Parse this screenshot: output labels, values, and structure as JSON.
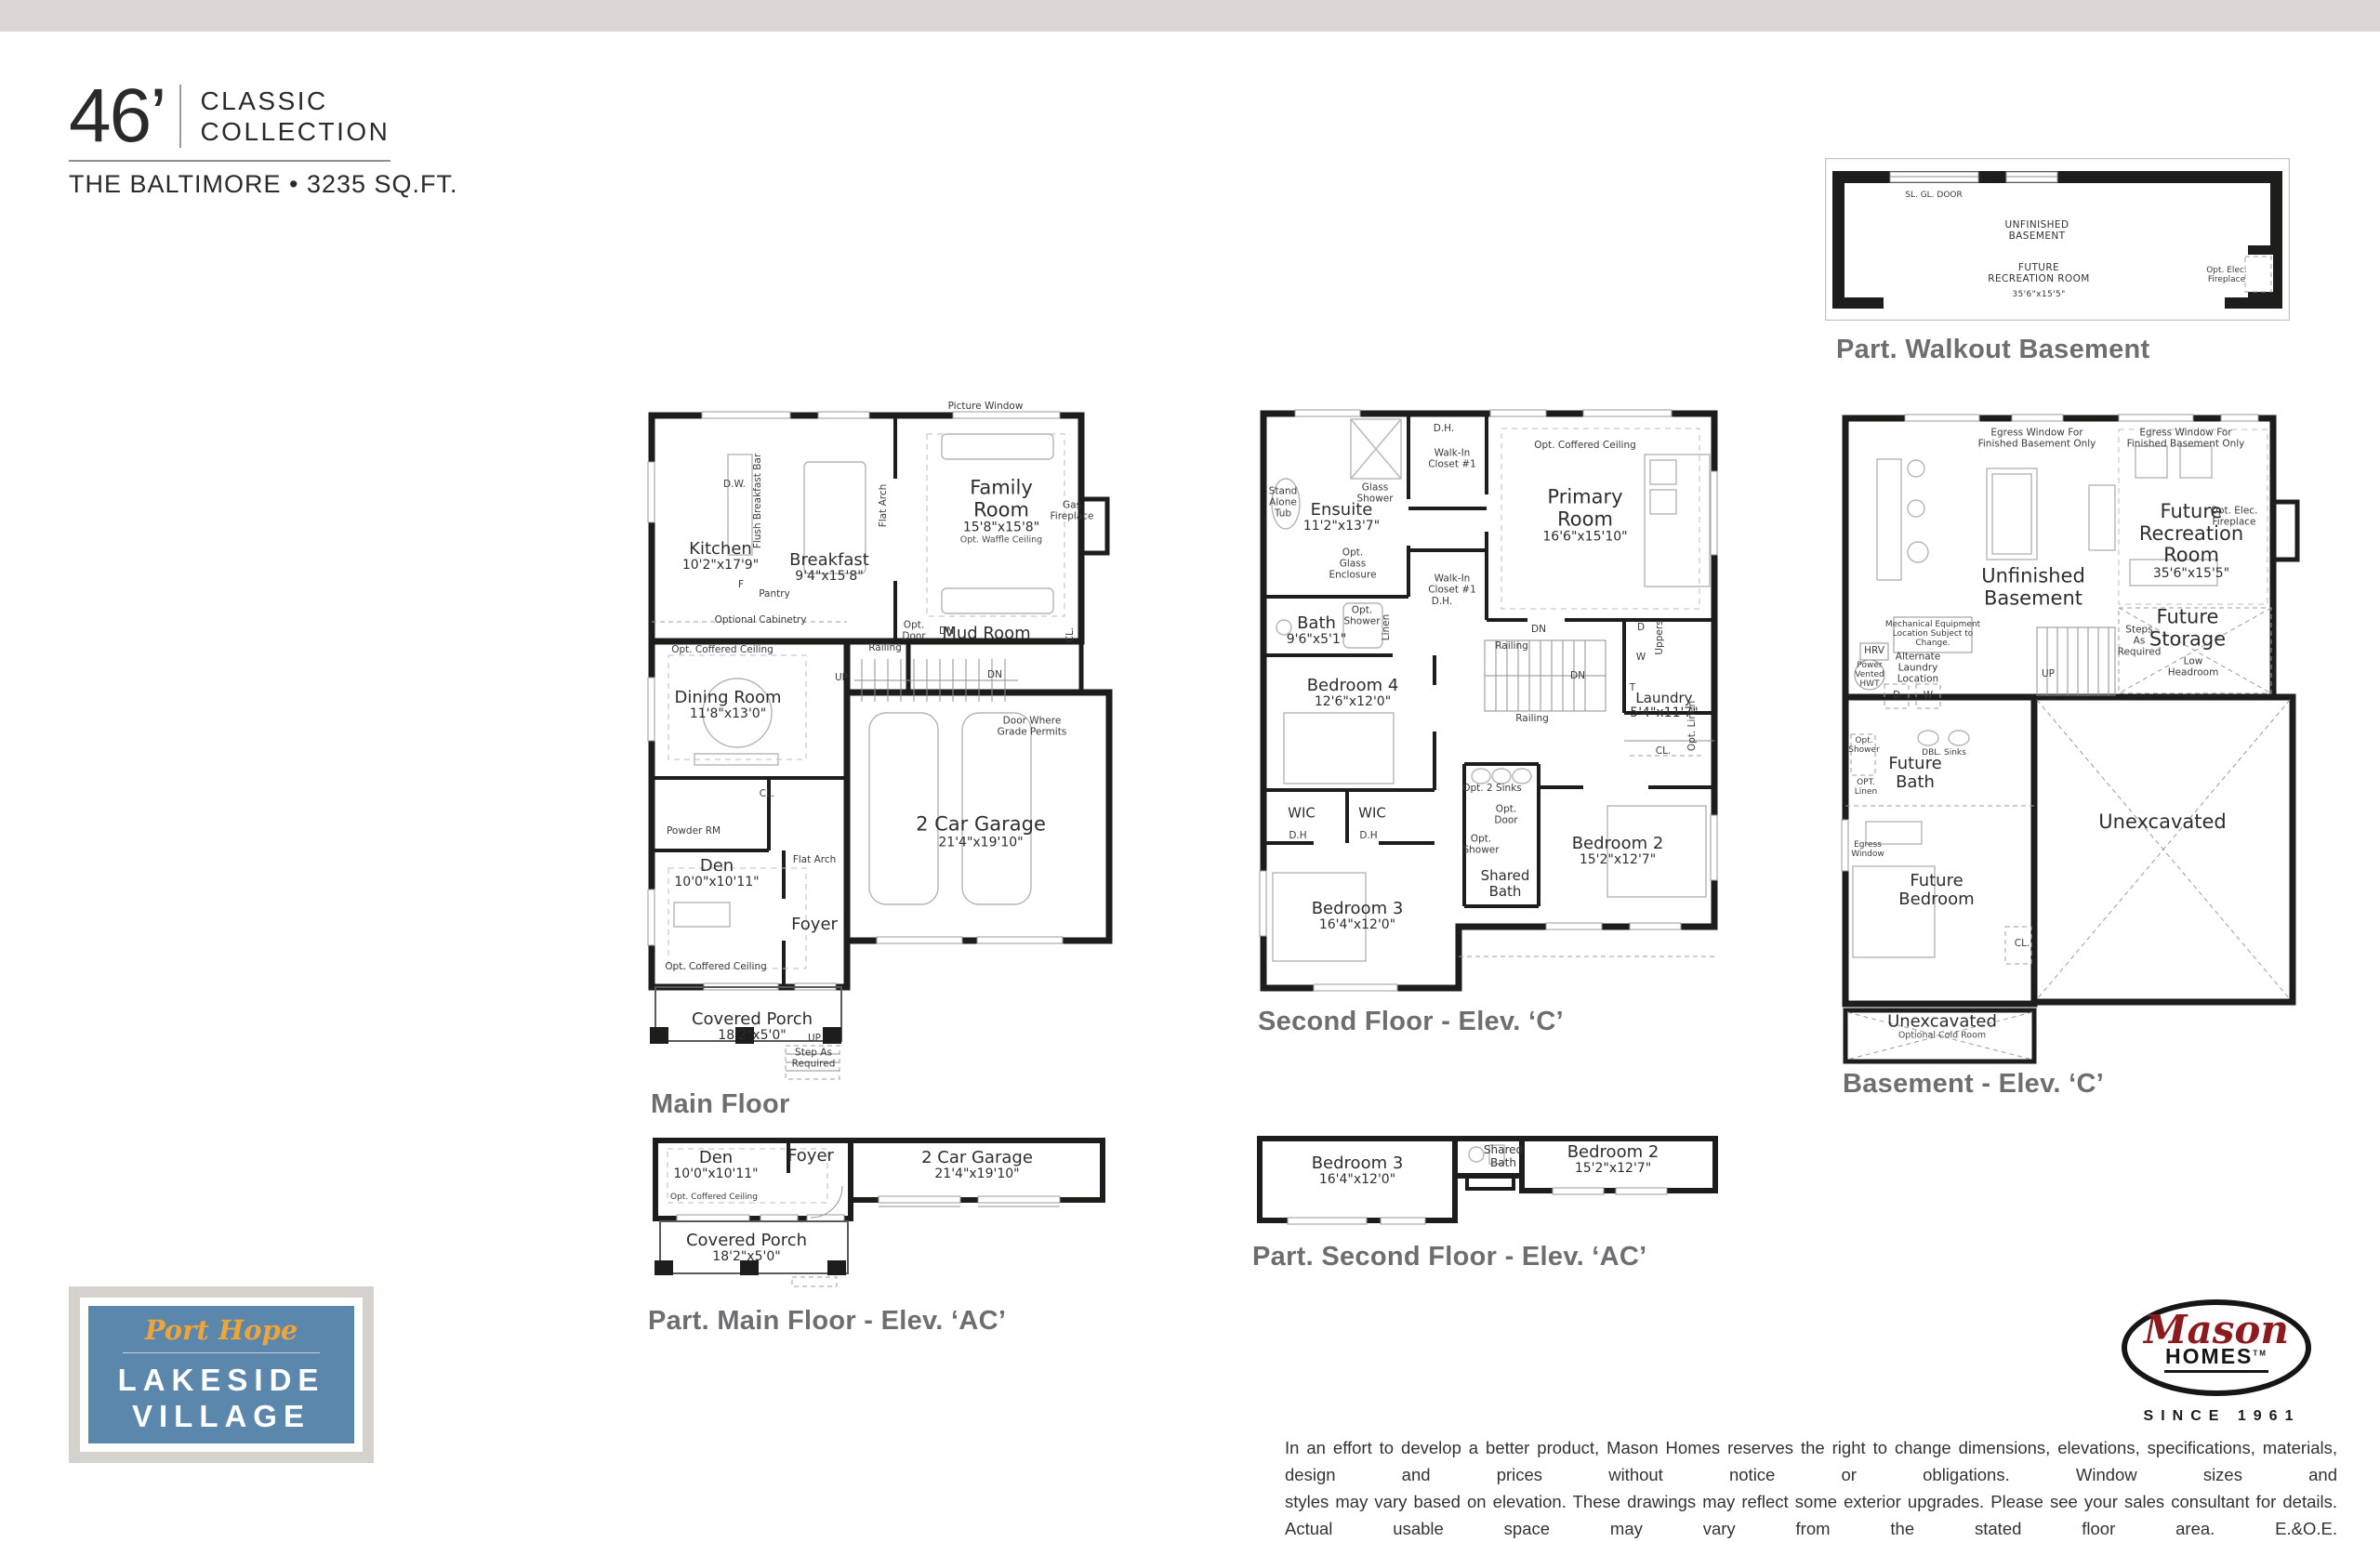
{
  "page": {
    "top_bar_color": "#dbd8d3",
    "background": "#ffffff",
    "wall_color": "#1d1d1b",
    "caption_color": "#6d6e71",
    "brand_blue": "#5c87ac",
    "brand_gold": "#eda43c",
    "brand_red": "#8c1a1e"
  },
  "header": {
    "width_label": "46’",
    "collection_line1": "CLASSIC",
    "collection_line2": "COLLECTION",
    "model_line": "THE BALTIMORE • 3235 SQ.FT."
  },
  "captions": {
    "main": "Main Floor",
    "second": "Second Floor - Elev. ‘C’",
    "basement": "Basement - Elev. ‘C’",
    "walkout": "Part. Walkout Basement",
    "part_main": "Part. Main Floor - Elev. ‘AC’",
    "part_second": "Part. Second Floor - Elev. ‘AC’"
  },
  "plans": {
    "main": {
      "rooms": [
        {
          "n": "Kitchen",
          "d": "10'2\"x17'9\""
        },
        {
          "n": "Breakfast",
          "d": "9'4\"x15'8\""
        },
        {
          "n": "Family Room",
          "d": "15'8\"x15'8\"",
          "s": "Opt. Waffle Ceiling"
        },
        {
          "n": "Dining Room",
          "d": "11'8\"x13'0\""
        },
        {
          "n": "Den",
          "d": "10'0\"x10'11\""
        },
        {
          "n": "Foyer"
        },
        {
          "n": "Mud Room"
        },
        {
          "n": "2 Car Garage",
          "d": "21'4\"x19'10\""
        },
        {
          "n": "Covered Porch",
          "d": "18'2\"x5'0\""
        }
      ],
      "notes": [
        "Picture Window",
        "D.W.",
        "Flush Breakfast Bar",
        "Flat Arch",
        "Gas\nFireplace",
        "F",
        "Pantry",
        "Optional Cabinetry",
        "Opt. Coffered Ceiling",
        "Opt.\nDoor",
        "DN",
        "CL.",
        "Railing",
        "UP",
        "DN",
        "Door Where\nGrade Permits",
        "Powder RM",
        "CL.",
        "Flat Arch",
        "Opt. Coffered Ceiling",
        "UP",
        "Step As\nRequired"
      ]
    },
    "second": {
      "rooms": [
        {
          "n": "Ensuite",
          "d": "11'2\"x13'7\""
        },
        {
          "n": "Primary Room",
          "d": "16'6\"x15'10\""
        },
        {
          "n": "Bath",
          "d": "9'6\"x5'1\""
        },
        {
          "n": "Bedroom 4",
          "d": "12'6\"x12'0\""
        },
        {
          "n": "Laundry",
          "d": "5'4\"x11'7\""
        },
        {
          "n": "Bedroom 2",
          "d": "15'2\"x12'7\""
        },
        {
          "n": "Bedroom 3",
          "d": "16'4\"x12'0\""
        },
        {
          "n": "Shared\nBath"
        }
      ],
      "notes": [
        "Opt. Coffered Ceiling",
        "Stand\nAlone\nTub",
        "Glass\nShower",
        "Walk-In\nCloset #1",
        "Walk-In\nCloset #1",
        "D.H.",
        "D.H.",
        "Opt.\nGlass\nEnclosure",
        "Opt.\nShower",
        "Linen",
        "DN",
        "Railing",
        "Railing",
        "DN",
        "D",
        "W",
        "Uppers",
        "T",
        "Opt. Linen",
        "CL.",
        "WIC",
        "WIC",
        "D.H",
        "D.H",
        "Opt. 2 Sinks",
        "Opt.\nDoor",
        "Opt.\nShower"
      ]
    },
    "basement": {
      "rooms": [
        {
          "n": "Future\nRecreation Room",
          "d": "35'6\"x15'5\""
        },
        {
          "n": "Unfinished\nBasement"
        },
        {
          "n": "Future\nStorage"
        },
        {
          "n": "Future\nBath"
        },
        {
          "n": "Future\nBedroom"
        },
        {
          "n": "Unexcavated"
        },
        {
          "n": "Unexcavated",
          "s": "Optional Cold Room"
        }
      ],
      "notes": [
        "Egress Window For\nFinished Basement Only",
        "Egress Window For\nFinished Basement Only",
        "Opt. Elec.\nFireplace",
        "Mechanical Equipment\nLocation Subject to\nChange.",
        "HRV",
        "Power\nVented\nHWT",
        "Alternate\nLaundry\nLocation",
        "D",
        "W",
        "Steps\nAs\nRequired",
        "UP",
        "Low\nHeadroom",
        "Opt.\nShower",
        "DBL. Sinks",
        "OPT.\nLinen",
        "Egress\nWindow",
        "CL."
      ]
    },
    "walkout": {
      "rooms": [
        {
          "n": "UNFINISHED\nBASEMENT"
        },
        {
          "n": "FUTURE\nRECREATION ROOM",
          "d": "35'6\"x15'5\""
        }
      ],
      "notes": [
        "SL. GL. DOOR",
        "Opt. Elec.\nFireplace"
      ]
    },
    "part_main": {
      "rooms": [
        {
          "n": "Den",
          "d": "10'0\"x10'11\""
        },
        {
          "n": "Foyer"
        },
        {
          "n": "2 Car Garage",
          "d": "21'4\"x19'10\""
        },
        {
          "n": "Covered Porch",
          "d": "18'2\"x5'0\""
        }
      ],
      "notes": [
        "Opt. Coffered Ceiling"
      ]
    },
    "part_second": {
      "rooms": [
        {
          "n": "Bedroom 3",
          "d": "16'4\"x12'0\""
        },
        {
          "n": "Shared\nBath"
        },
        {
          "n": "Bedroom 2",
          "d": "15'2\"x12'7\""
        }
      ],
      "notes": []
    }
  },
  "logos": {
    "lakeside": {
      "top": "Port Hope",
      "line1": "LAKESIDE",
      "line2": "VILLAGE"
    },
    "mason": {
      "script": "Mason",
      "word": "HOMES",
      "tm": "TM",
      "since": "SINCE 1961"
    }
  },
  "disclaimer": {
    "line1": "In an effort to develop a better product, Mason Homes reserves the right to change dimensions, elevations, specifications, materials, design and prices without notice or obligations. Window sizes and",
    "line2": "styles may vary based on elevation. These drawings may reflect some exterior upgrades. Please see your sales consultant for details. Actual usable space may vary from the stated floor area. E.&O.E."
  }
}
